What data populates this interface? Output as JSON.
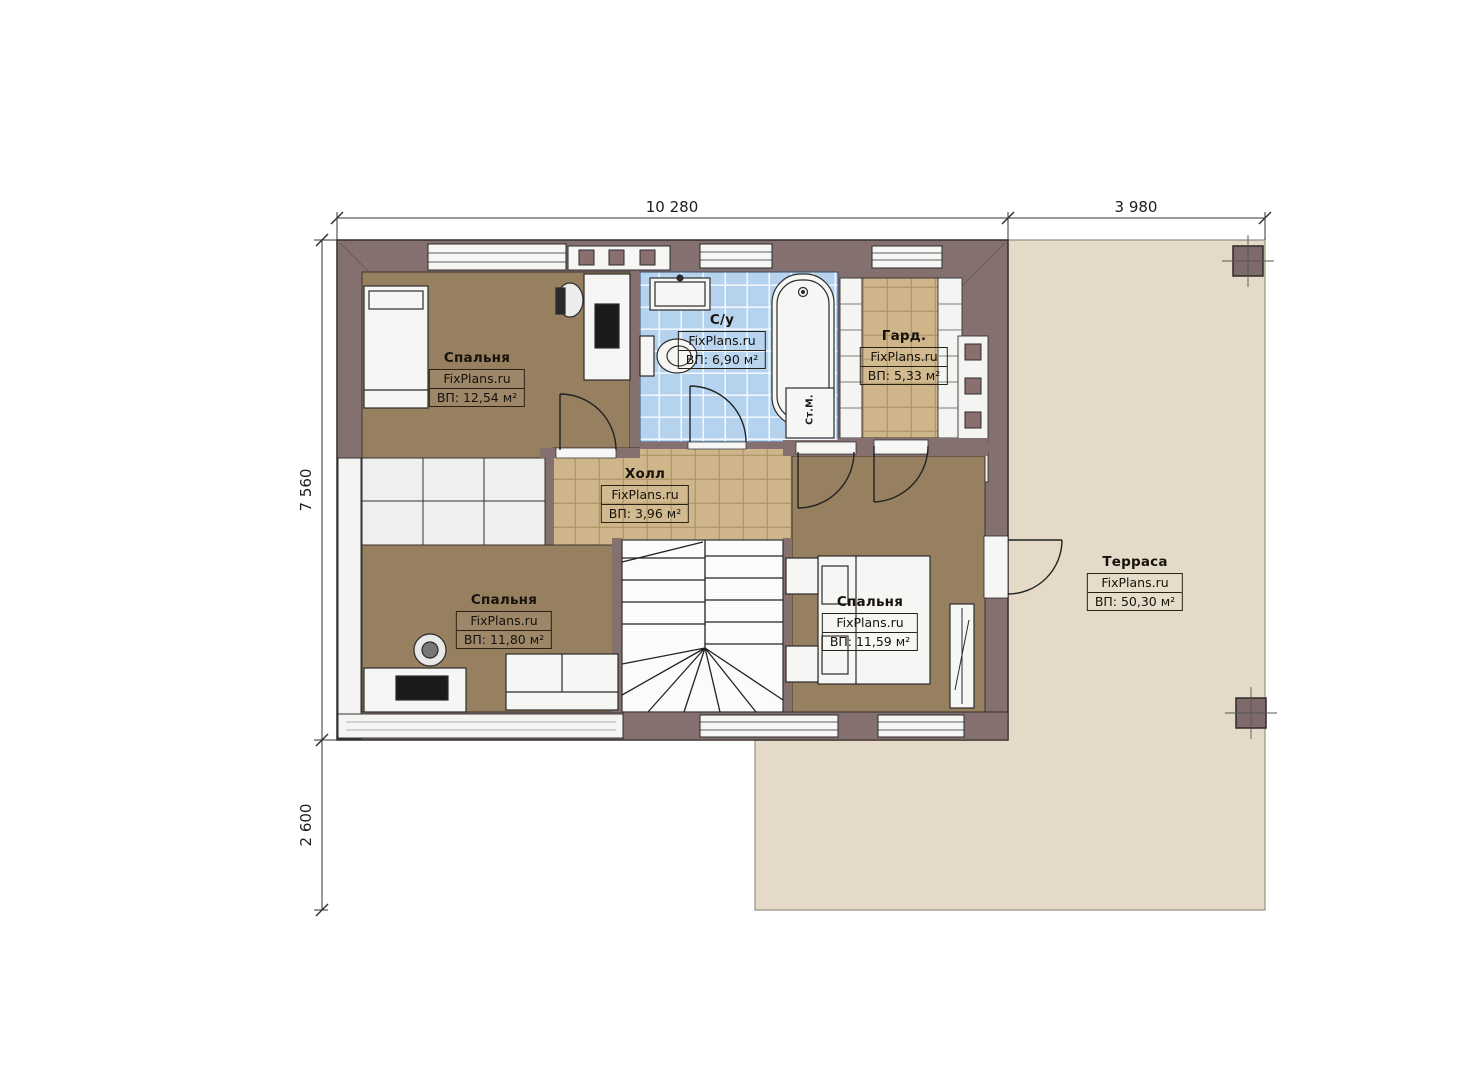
{
  "dimensions": {
    "top_total": "10 280",
    "top_terrace": "3 980",
    "left_main": "7 560",
    "left_lower": "2 600"
  },
  "rooms": [
    {
      "id": "bedroom-top-left",
      "name": "Спальня",
      "watermark": "FixPlans.ru",
      "area": "ВП: 12,54 м²"
    },
    {
      "id": "bathroom",
      "name": "С/у",
      "watermark": "FixPlans.ru",
      "area": "ВП: 6,90 м²"
    },
    {
      "id": "wardrobe",
      "name": "Гард.",
      "watermark": "FixPlans.ru",
      "area": "ВП: 5,33 м²"
    },
    {
      "id": "hall",
      "name": "Холл",
      "watermark": "FixPlans.ru",
      "area": "ВП: 3,96 м²"
    },
    {
      "id": "bedroom-bottom-left",
      "name": "Спальня",
      "watermark": "FixPlans.ru",
      "area": "ВП: 11,80 м²"
    },
    {
      "id": "bedroom-bottom-right",
      "name": "Спальня",
      "watermark": "FixPlans.ru",
      "area": "ВП: 11,59 м²"
    },
    {
      "id": "terrace",
      "name": "Терраса",
      "watermark": "FixPlans.ru",
      "area": "ВП: 50,30 м²"
    }
  ],
  "labels": {
    "washing_machine": "Ст.М."
  },
  "colors": {
    "wall": "#857070",
    "floor_wood": "#97805f",
    "tile_blue": "#b5d2ef",
    "tile_tan": "#cfb68a",
    "terrace": "#e4dac7",
    "fixture_white": "#f5f5f3",
    "line": "#222222"
  }
}
